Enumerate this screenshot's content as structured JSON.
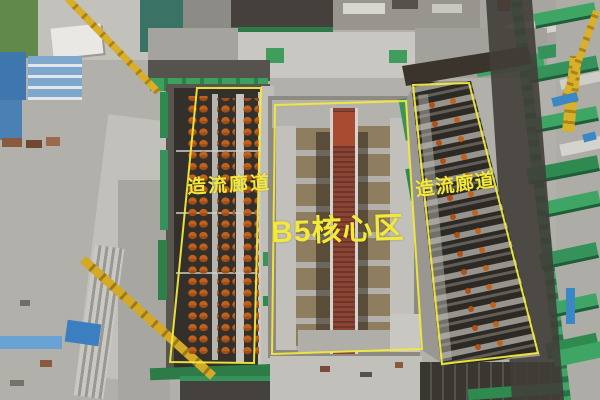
{
  "annotations": {
    "left_corridor": {
      "label": "造流廊道"
    },
    "core_area": {
      "label": "B5核心区"
    },
    "right_corridor": {
      "label": "造流廊道"
    }
  },
  "colors": {
    "annotation_yellow": "#f2e93a",
    "netting_green": "#3da463",
    "crane_yellow": "#d8ae2a",
    "equipment_orange": "#c2611c",
    "rebar_brown": "#8a4434",
    "pit_dark": "#33302c",
    "concrete_gray": "#b2b0ab",
    "building_blue": "#3e76ae"
  }
}
